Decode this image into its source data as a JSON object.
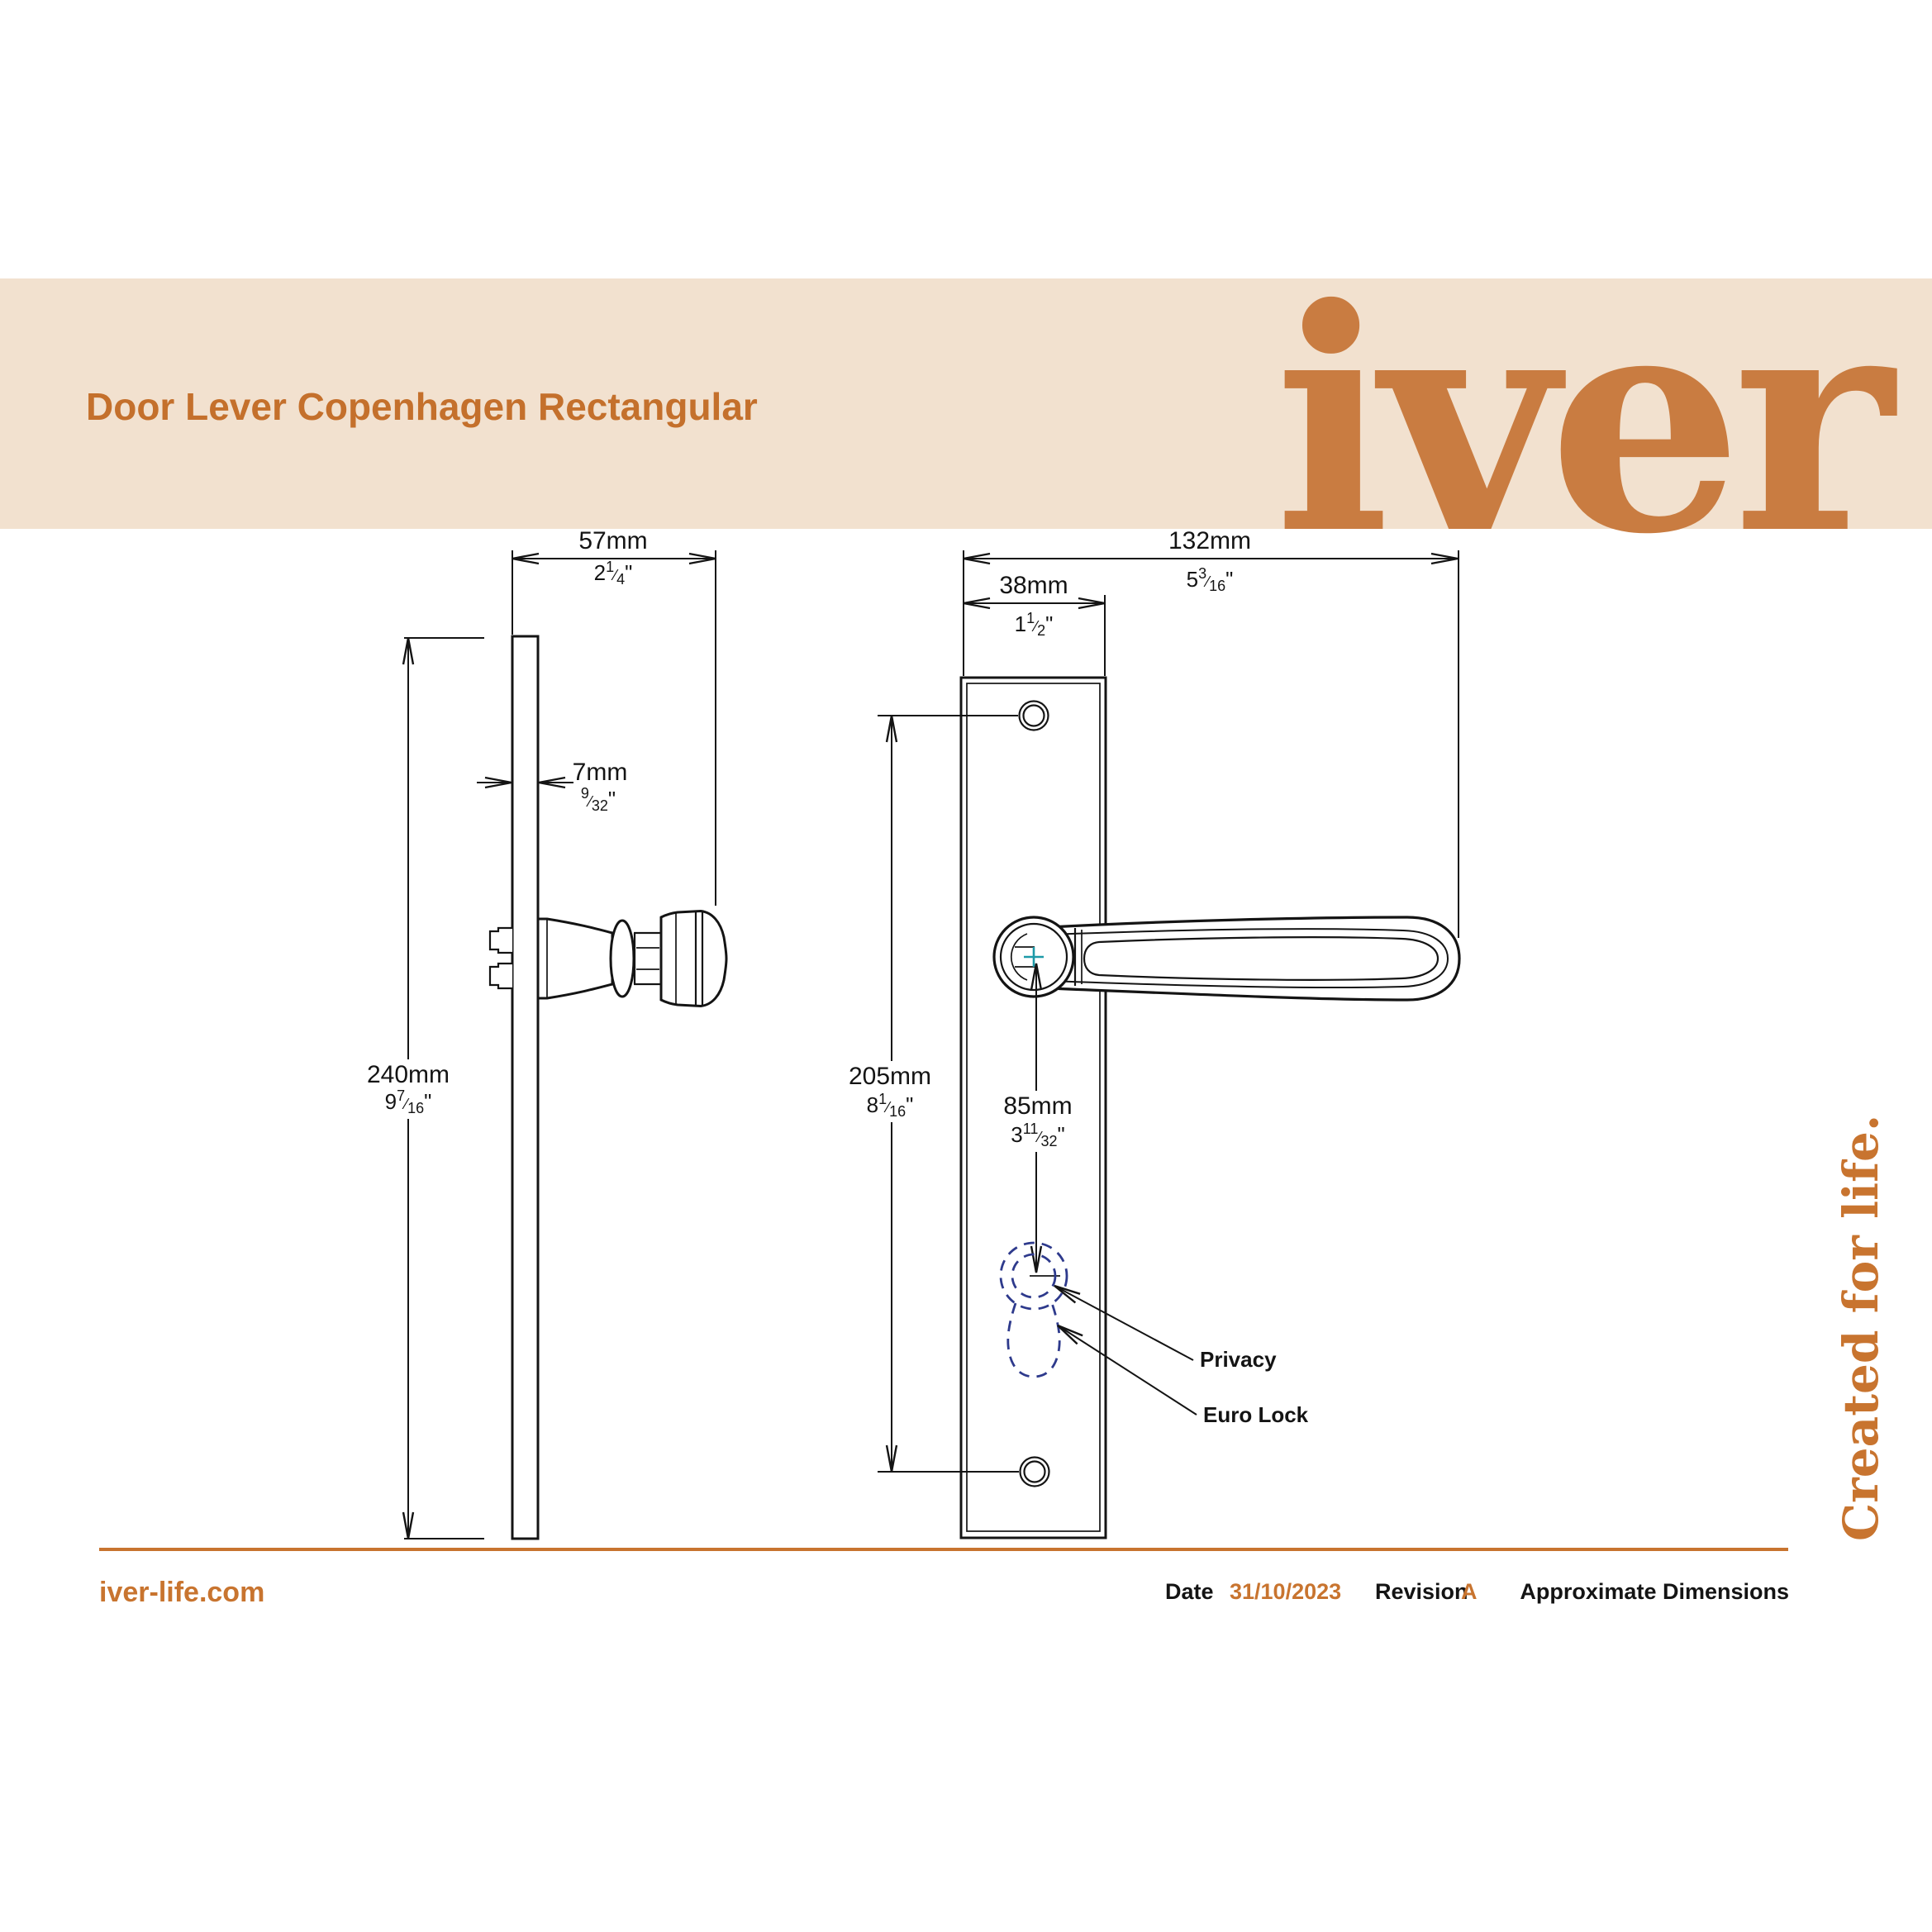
{
  "header": {
    "title": "Door Lever Copenhagen Rectangular",
    "logo": "iver"
  },
  "tagline": "Created for life.",
  "marks": {
    "frac": "⁄",
    "inch": "\""
  },
  "drawing": {
    "side_view": {
      "height": {
        "mm": "240mm",
        "whole": "9",
        "num": "7",
        "den": "16"
      },
      "width": {
        "mm": "57mm",
        "whole": "2",
        "num": "1",
        "den": "4"
      },
      "thickness": {
        "mm": "7mm",
        "num": "9",
        "den": "32"
      }
    },
    "front_view": {
      "overall_width": {
        "mm": "132mm",
        "whole": "5",
        "num": "3",
        "den": "16"
      },
      "plate_width": {
        "mm": "38mm",
        "whole": "1",
        "num": "1",
        "den": "2"
      },
      "fixing_centres": {
        "mm": "205mm",
        "whole": "8",
        "num": "1",
        "den": "16"
      },
      "centre_to_cylinder": {
        "mm": "85mm",
        "whole": "3",
        "num": "11",
        "den": "32"
      },
      "annotations": {
        "privacy": "Privacy",
        "euro_lock": "Euro Lock"
      }
    }
  },
  "footer": {
    "website": "iver-life.com",
    "date_label": "Date",
    "date_value": "31/10/2023",
    "revision_label": "Revision",
    "revision_value": "A",
    "note": "Approximate Dimensions"
  }
}
